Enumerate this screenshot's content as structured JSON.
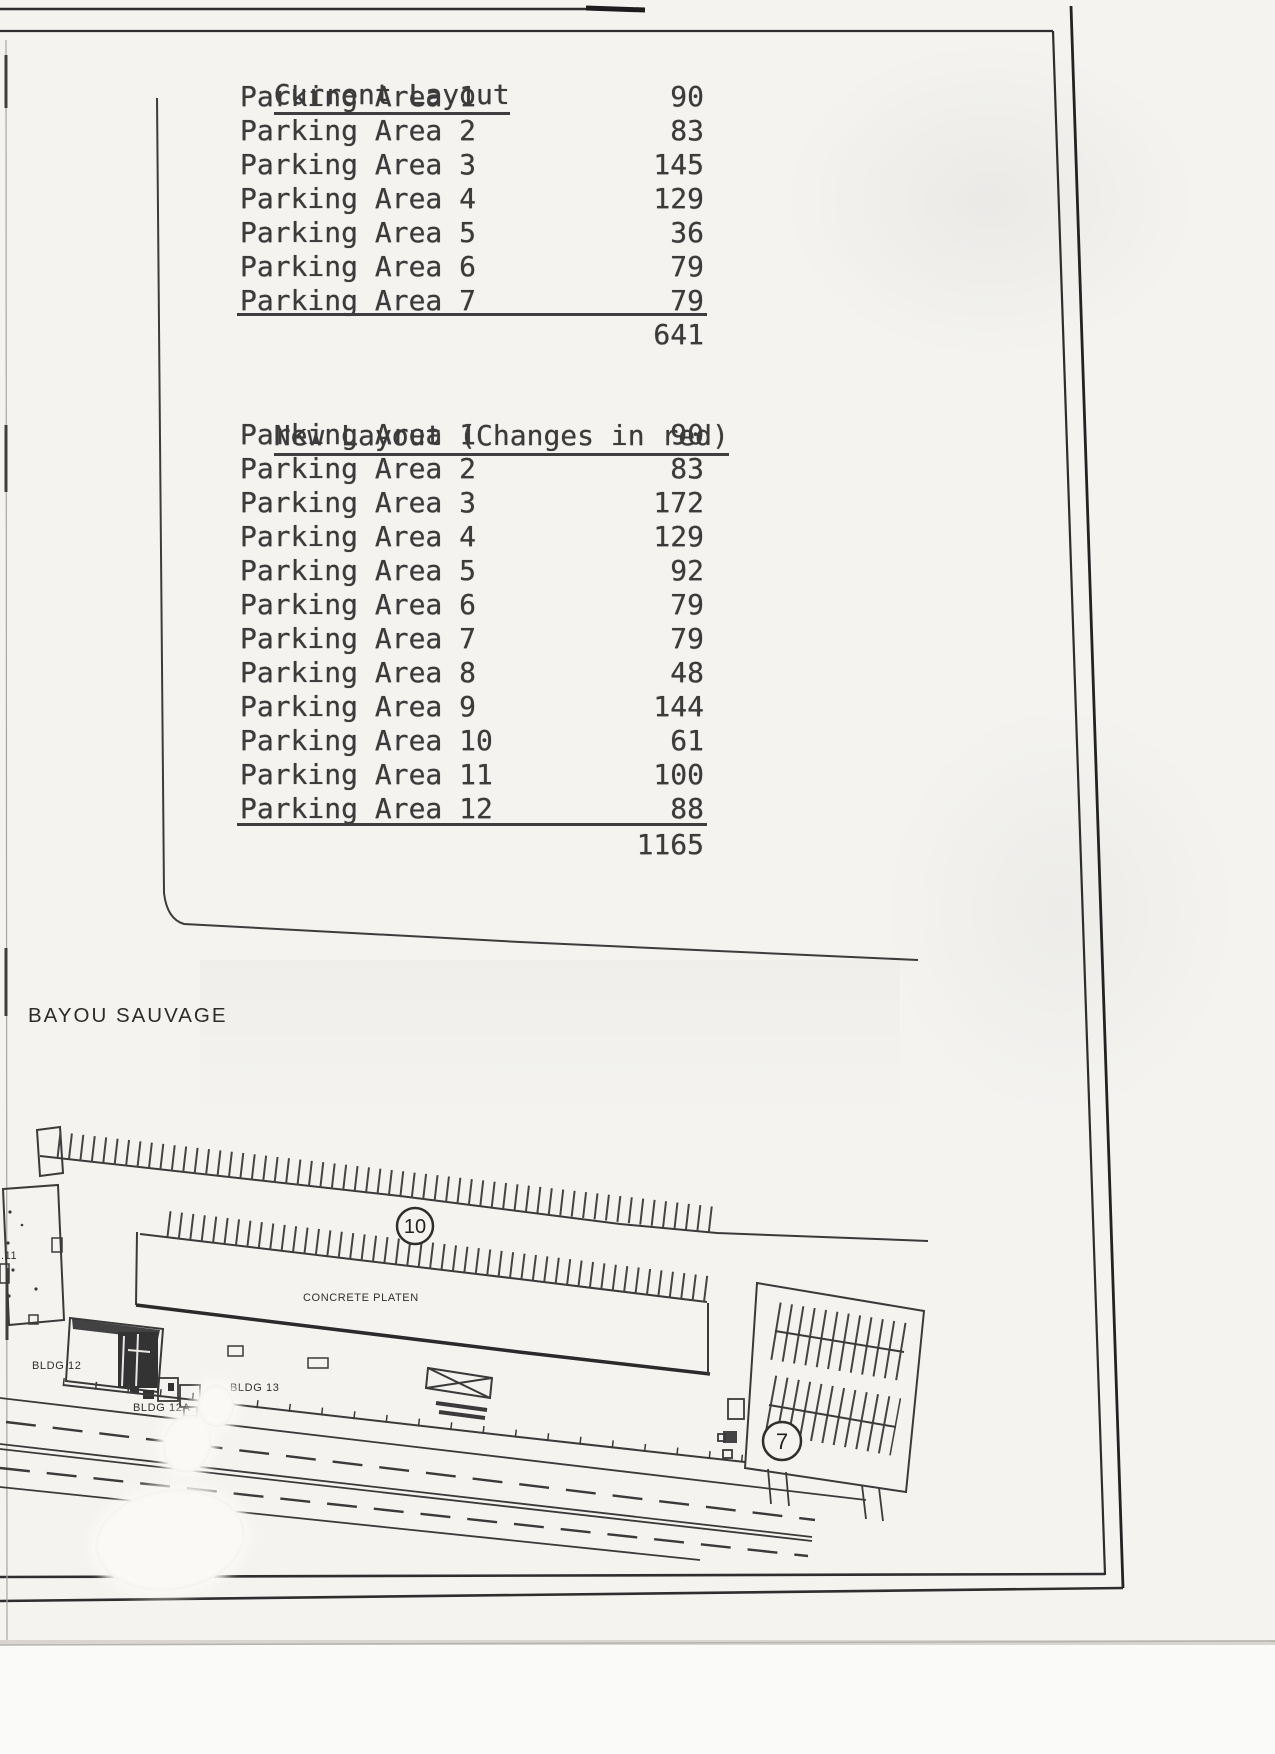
{
  "document": {
    "tables": {
      "current": {
        "title": "Current Layout",
        "rows": [
          {
            "label": "Parking Area 1",
            "value": "90"
          },
          {
            "label": "Parking Area 2",
            "value": "83"
          },
          {
            "label": "Parking Area 3",
            "value": "145"
          },
          {
            "label": "Parking Area 4",
            "value": "129"
          },
          {
            "label": "Parking Area 5",
            "value": "36"
          },
          {
            "label": "Parking Area 6",
            "value": "79"
          },
          {
            "label": "Parking Area 7",
            "value": "79"
          }
        ],
        "total": "641"
      },
      "new": {
        "title": "New Layout (Changes in red)",
        "rows": [
          {
            "label": "Parking Area 1",
            "value": "90"
          },
          {
            "label": "Parking Area 2",
            "value": "83"
          },
          {
            "label": "Parking Area 3",
            "value": "172"
          },
          {
            "label": "Parking Area 4",
            "value": "129"
          },
          {
            "label": "Parking Area 5",
            "value": "92"
          },
          {
            "label": "Parking Area 6",
            "value": "79"
          },
          {
            "label": "Parking Area 7",
            "value": "79"
          },
          {
            "label": "Parking Area 8",
            "value": "48"
          },
          {
            "label": "Parking Area 9",
            "value": "144"
          },
          {
            "label": "Parking Area 10",
            "value": "61"
          },
          {
            "label": "Parking Area 11",
            "value": "100"
          },
          {
            "label": "Parking Area 12",
            "value": "88"
          }
        ],
        "total": "1165"
      }
    },
    "map": {
      "region_label": "BAYOU SAUVAGE",
      "plan_labels": {
        "concrete_platen": "CONCRETE PLATEN",
        "bldg_11": ".11",
        "bldg_12": "BLDG 12",
        "bldg_12a": "BLDG 12A",
        "bldg_13": "BLDG 13"
      },
      "area_markers": {
        "area_10": "10",
        "area_7": "7"
      }
    }
  }
}
